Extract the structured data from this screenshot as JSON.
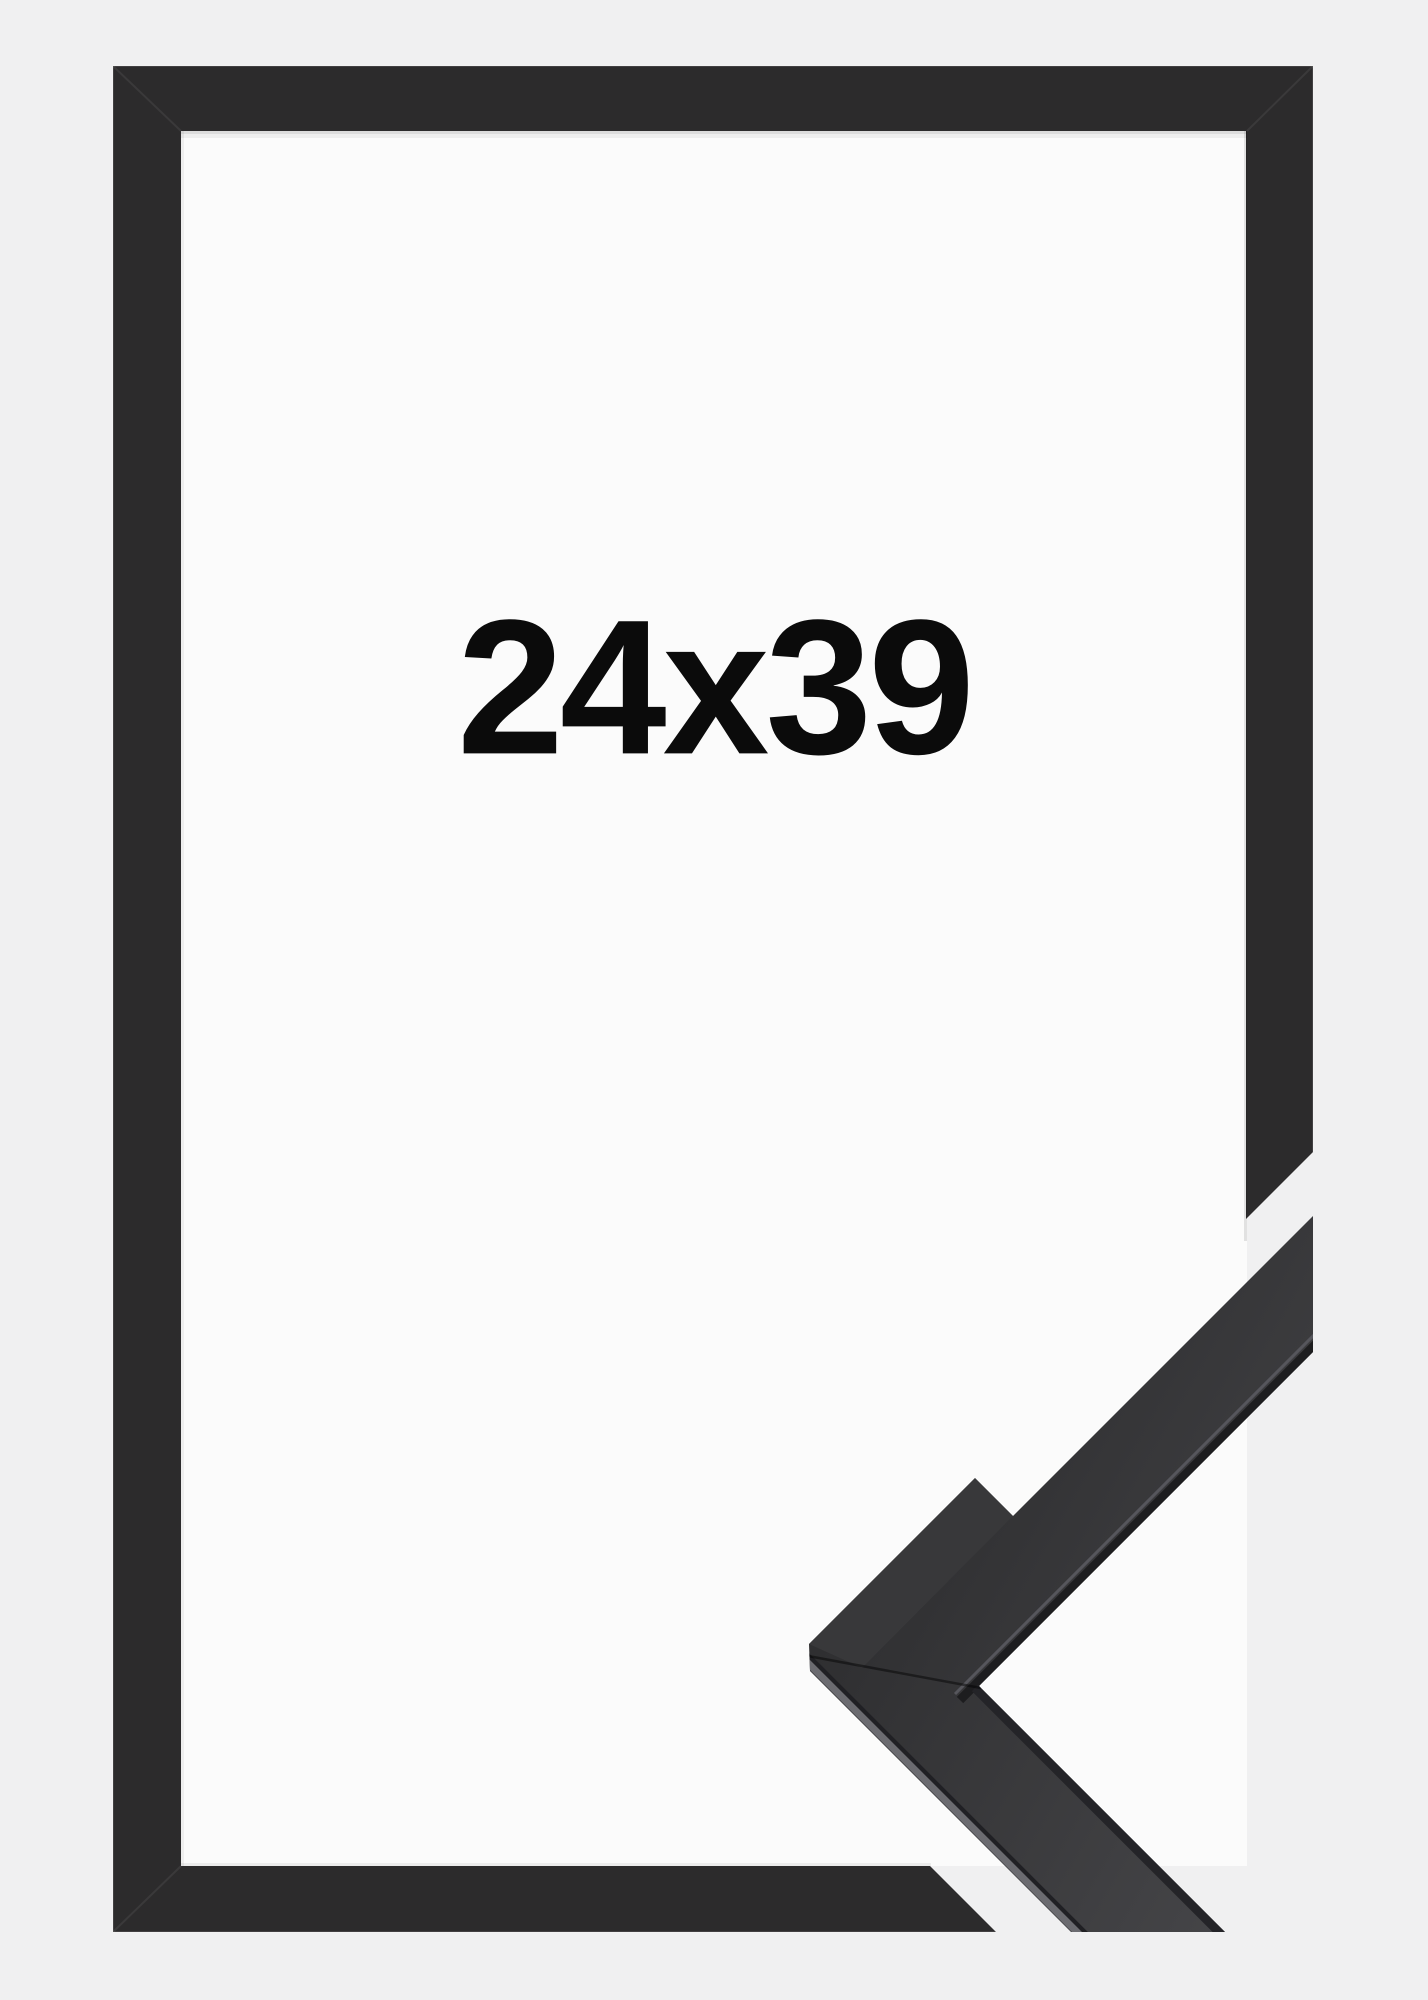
{
  "product": {
    "size_label": "24x39"
  },
  "colors": {
    "background": "#f0f0f1",
    "opening": "#fbfbfb",
    "frame": "#2c2b2c",
    "sample_gradient_start": "#2f2f31",
    "sample_gradient_end": "#47474a",
    "sample_top_face": "#38383a",
    "text": "#0b0b0b"
  }
}
